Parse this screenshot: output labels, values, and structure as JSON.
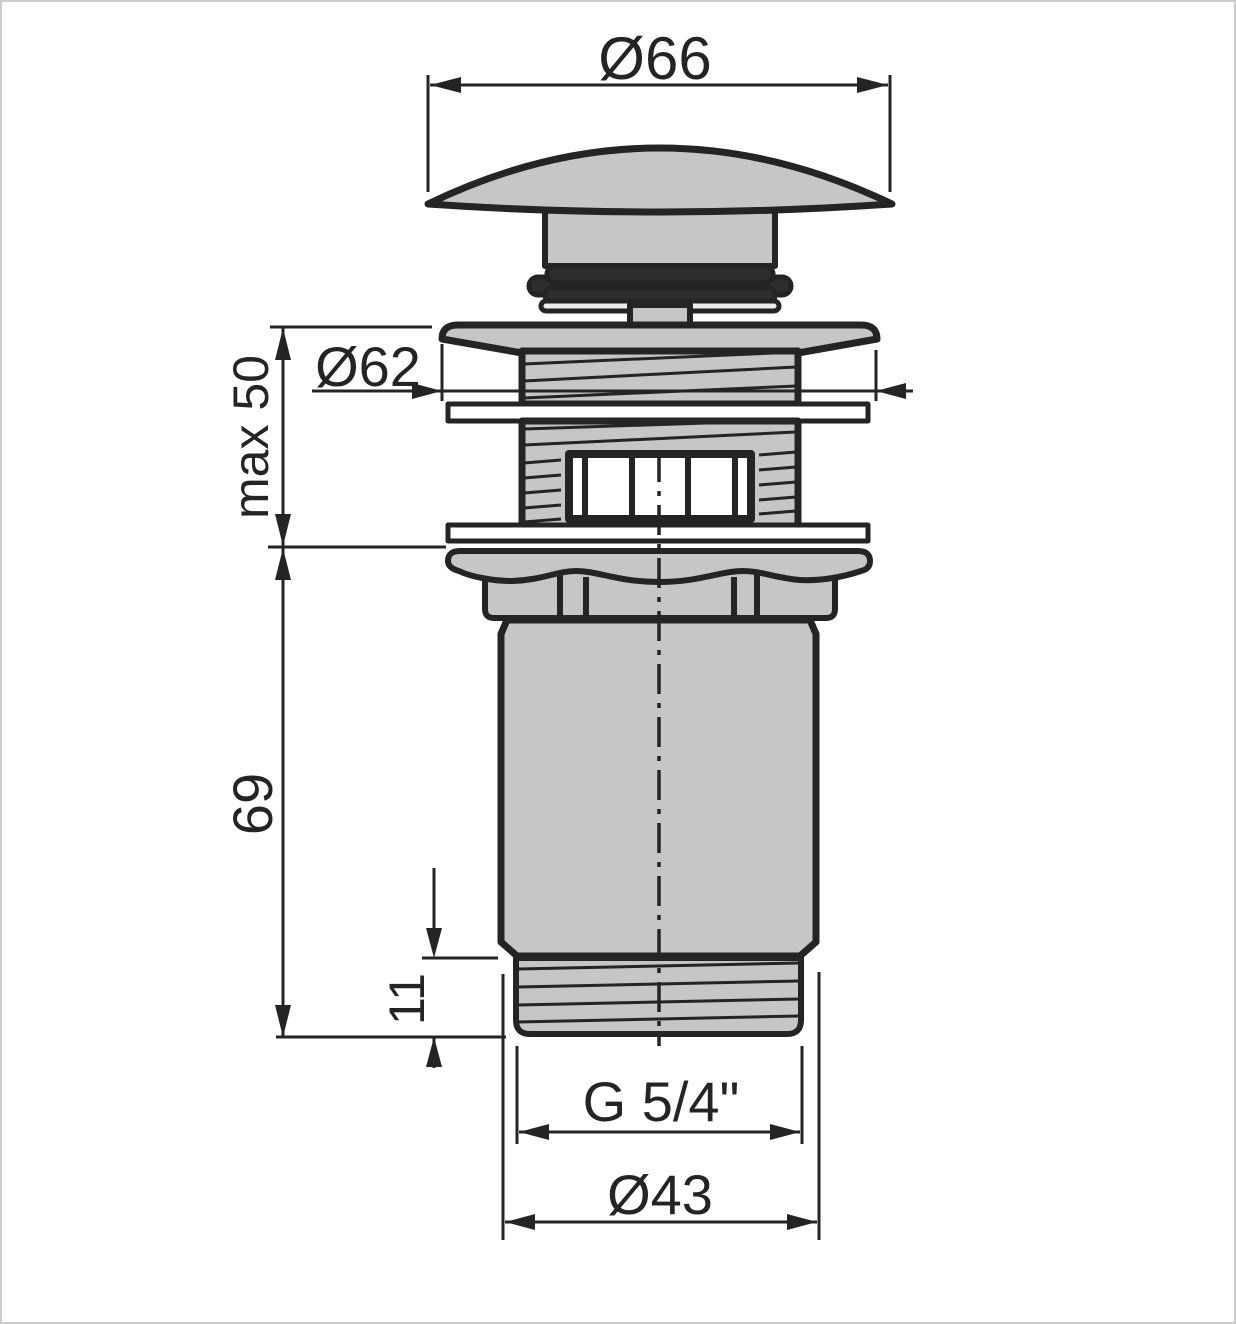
{
  "drawing": {
    "type": "technical-dimension-drawing",
    "subject": "click-clack basin waste drain valve, sectional side view",
    "labels": {
      "cap_diameter": "Ø66",
      "flange_diameter": "Ø62",
      "max_clamp_height": "max 50",
      "body_height": "69",
      "thread_length": "11",
      "thread_size": "G 5/4\"",
      "outlet_diameter": "Ø43"
    },
    "colors": {
      "line": "#242426",
      "fill": "#c5c6c8",
      "seal_dark": "#2e2e30",
      "seal_light": "#ededee",
      "white": "#ffffff",
      "frame": "#cccccc",
      "background": "#ffffff"
    }
  }
}
